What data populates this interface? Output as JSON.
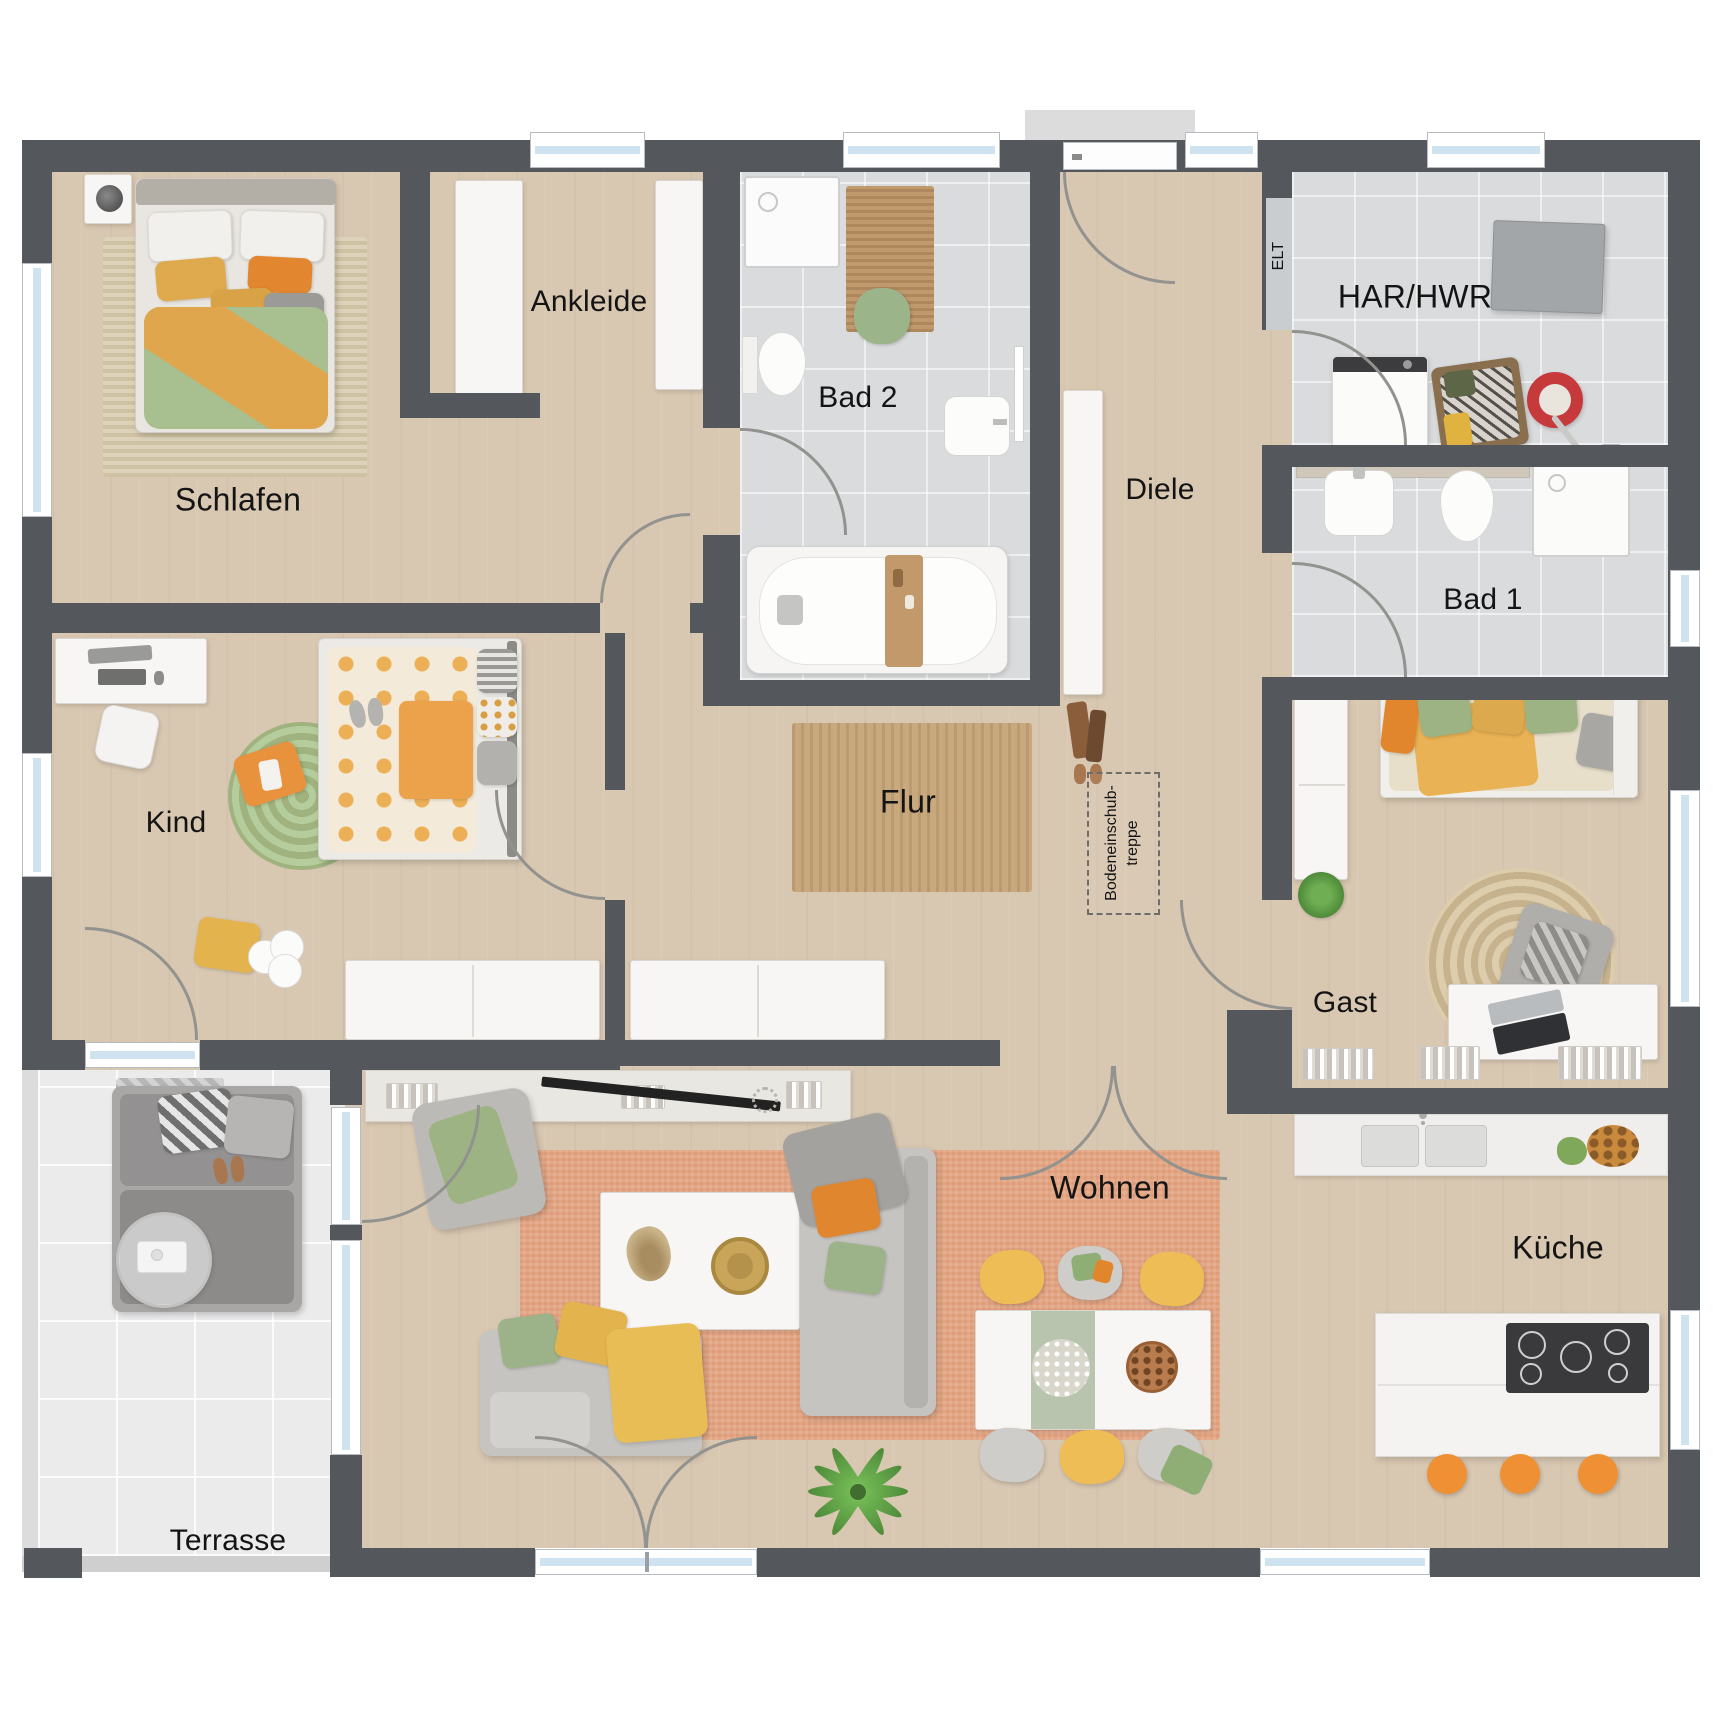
{
  "meta": {
    "type": "floor-plan",
    "style": "top-down furnished bungalow plan"
  },
  "rooms": {
    "schlafen": "Schlafen",
    "ankleide": "Ankleide",
    "bad2": "Bad 2",
    "diele": "Diele",
    "elt": "ELT",
    "har_hwr": "HAR/HWR",
    "bad1": "Bad 1",
    "kind": "Kind",
    "flur": "Flur",
    "attic_line1": "Bodeneinschub-",
    "attic_line2": "treppe",
    "gast": "Gast",
    "wohnen": "Wohnen",
    "kueche": "Küche",
    "terrasse": "Terrasse"
  },
  "colors": {
    "wall": "#54575c",
    "wood": "#d8c7b1",
    "tile": "#d9dbdd",
    "terrace": "#ebebec",
    "glass": "#cfe2f0",
    "accent_orange": "#ee9033",
    "accent_green": "#a8bf8f",
    "accent_yellow": "#e3b44e",
    "rug_salmon": "#e4a583",
    "rug_jute": "#c8a97e"
  }
}
